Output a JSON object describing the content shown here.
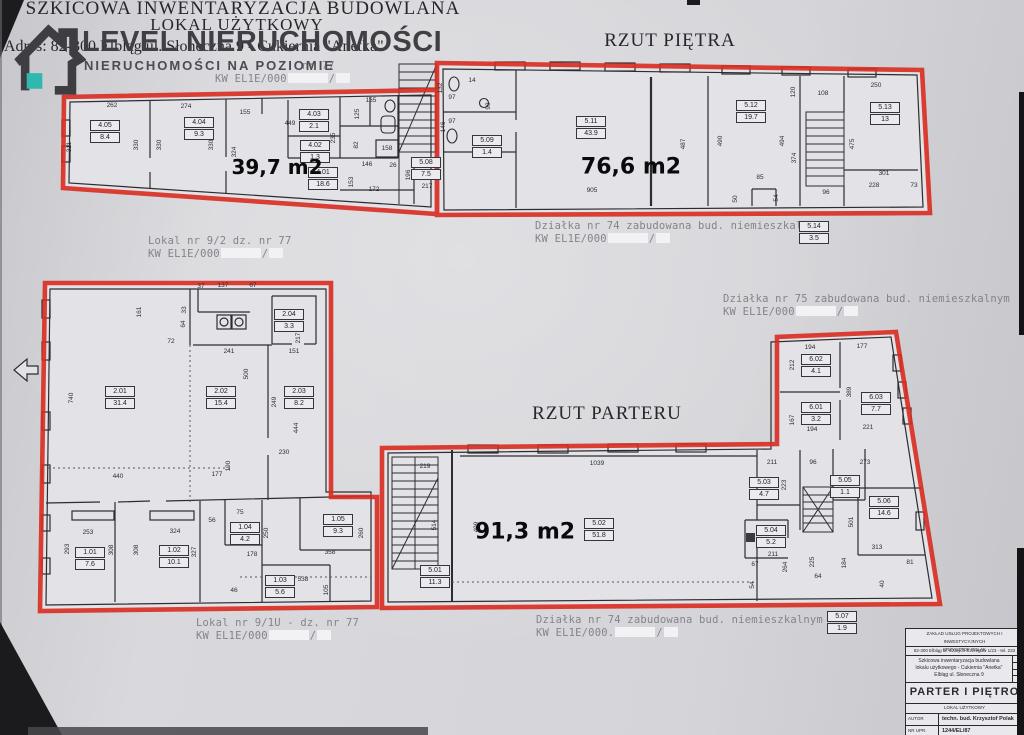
{
  "common": {
    "slash": "/"
  },
  "header": {
    "title_line1": "SZKICOWA INWENTARYZACJA BUDOWLANA",
    "title_line2": "LOKAL UŻYTKOWY",
    "address": "Adres: 82-300 Elbląg ul. Słoneczna 9 - Cukiernia \"Anetka\"",
    "fragment": "nr 77",
    "kw": "KW EL1E/000"
  },
  "watermark": {
    "brand": "LEVEL NIERUCHOMOŚCI",
    "tagline": "NIERUCHOMOŚCI NA POZIOMIE",
    "accent_color": "#2fb8b0",
    "text_color": "#3f3f44"
  },
  "floor_titles": {
    "upper": "RZUT PIĘTRA",
    "ground": "RZUT PARTERU"
  },
  "area_labels": {
    "planA": "39,7 m2",
    "planB": "76,6 m2",
    "planD": "91,3 m2"
  },
  "colors": {
    "outline_red": "#d92b1f"
  },
  "notes": {
    "lokal92": {
      "l1": "Lokal nr 9/2 dz. nr 77",
      "kw": "KW EL1E/000"
    },
    "dz74top": {
      "l1": "Działka nr 74 zabudowana bud. niemieszkalnym",
      "kw": "KW EL1E/000"
    },
    "dz75": {
      "l1": "Działka nr 75 zabudowana bud. niemieszkalnym",
      "kw": "KW EL1E/000"
    },
    "lokal91u": {
      "l1": "Lokal nr 9/1U - dz. nr 77",
      "kw": "KW EL1E/000"
    },
    "dz74bot": {
      "l1": "Działka nr 74 zabudowana bud. niemieszkalnym",
      "kw": "KW EL1E/000."
    }
  },
  "rooms": {
    "r405": {
      "id": "4.05",
      "area": "8.4"
    },
    "r404": {
      "id": "4.04",
      "area": "9.3"
    },
    "r403": {
      "id": "4.03",
      "area": "2.1"
    },
    "r402": {
      "id": "4.02",
      "area": "1.3"
    },
    "r401": {
      "id": "4.01",
      "area": "18.6"
    },
    "r508": {
      "id": "5.08",
      "area": "7.5"
    },
    "r509": {
      "id": "5.09",
      "area": "1.4"
    },
    "r511": {
      "id": "5.11",
      "area": "43.9"
    },
    "r512": {
      "id": "5.12",
      "area": "19.7"
    },
    "r513": {
      "id": "5.13",
      "area": "13"
    },
    "r514": {
      "id": "5.14",
      "area": "3.5"
    },
    "r201": {
      "id": "2.01",
      "area": "31.4"
    },
    "r202": {
      "id": "2.02",
      "area": "15.4"
    },
    "r203": {
      "id": "2.03",
      "area": "8.2"
    },
    "r204": {
      "id": "2.04",
      "area": "3.3"
    },
    "r101": {
      "id": "1.01",
      "area": "7.6"
    },
    "r102": {
      "id": "1.02",
      "area": "10.1"
    },
    "r103": {
      "id": "1.03",
      "area": "5.6"
    },
    "r104": {
      "id": "1.04",
      "area": "4.2"
    },
    "r105": {
      "id": "1.05",
      "area": "9.3"
    },
    "r501": {
      "id": "5.01",
      "area": "11.3"
    },
    "r502": {
      "id": "5.02",
      "area": "51.8"
    },
    "r503": {
      "id": "5.03",
      "area": "4.7"
    },
    "r504": {
      "id": "5.04",
      "area": "5.2"
    },
    "r505": {
      "id": "5.05",
      "area": "1.1"
    },
    "r506": {
      "id": "5.06",
      "area": "14.6"
    },
    "r507": {
      "id": "5.07",
      "area": "1.9"
    },
    "r601": {
      "id": "6.01",
      "area": "3.2"
    },
    "r602": {
      "id": "6.02",
      "area": "4.1"
    },
    "r603": {
      "id": "6.03",
      "area": "7.7"
    }
  },
  "dims": {
    "pA": [
      "262",
      "274",
      "155",
      "449",
      "311",
      "330",
      "330",
      "330",
      "324",
      "125",
      "165",
      "235",
      "82",
      "146",
      "26",
      "153",
      "172",
      "196",
      "217",
      "158"
    ],
    "pB": [
      "132",
      "97",
      "97",
      "146",
      "14",
      "93",
      "905",
      "487",
      "250",
      "108",
      "120",
      "490",
      "494",
      "374",
      "475",
      "85",
      "50",
      "54",
      "96",
      "301",
      "228",
      "73"
    ],
    "pC": [
      "37",
      "137",
      "67",
      "161",
      "33",
      "64",
      "72",
      "241",
      "500",
      "151",
      "217",
      "740",
      "249",
      "444",
      "230",
      "440",
      "177",
      "190",
      "253",
      "324",
      "293",
      "308",
      "308",
      "327",
      "56",
      "75",
      "250",
      "178",
      "358",
      "260",
      "538",
      "105",
      "46"
    ],
    "pD": [
      "219",
      "514",
      "499",
      "1039",
      "211",
      "96",
      "273",
      "223",
      "501",
      "211",
      "313",
      "225",
      "264",
      "67",
      "54",
      "64",
      "184",
      "81",
      "40",
      "194",
      "177",
      "212",
      "389",
      "167",
      "194",
      "221"
    ]
  },
  "titleblock": {
    "company_l1": "ZAKŁAD USŁUG PROJEKTOWYCH I INWESTYCYJNYCH",
    "company_l2": "KRZYSZTOF POLAK",
    "address": "82-300 Elbląg ul. Szarych Szeregów 1/23 - tel. 233",
    "subject_l1": "Szkicowa inwentaryzacja budowlana",
    "subject_l2": "lokalu użytkowego - Cukiernia \"Anetka\"",
    "subject_l3": "Elbląg ul. Słoneczna 9",
    "drawing_title": "PARTER I PIĘTRO",
    "drawing_type": "LOKAL UŻYTKOWY",
    "author_label": "AUTOR",
    "author_value": "techn. bud. Krzysztof Polak",
    "nr_label": "NR UPR. PROJ.",
    "nr_value": "1244/EL/87"
  }
}
